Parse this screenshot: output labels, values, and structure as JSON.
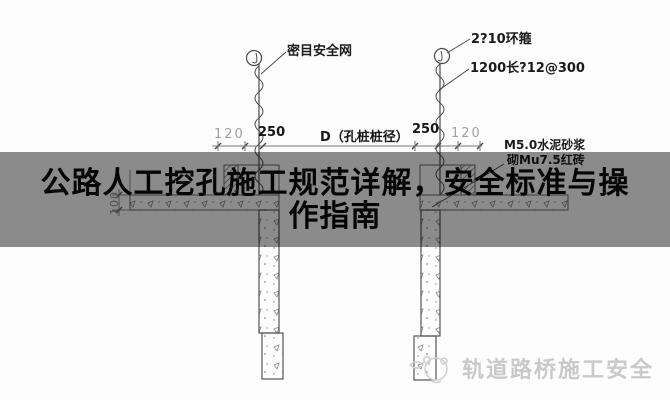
{
  "banner": {
    "title_line1": "公路人工挖孔施工规范详解，安全标准与操",
    "title_line2": "作指南"
  },
  "drawing": {
    "labels": {
      "safety_net": "密目安全网",
      "hoop": "2?10环箍",
      "rebar": "1200长?12@300",
      "mortar": "M5.0水泥砂浆",
      "brick": "砌Mu7.5红砖"
    },
    "dims": {
      "left_outer": "120",
      "left_wall": "250",
      "pile_diameter": "D（孔桩桩径）",
      "right_wall": "250",
      "right_outer": "120",
      "apron_height": "100"
    }
  },
  "watermark": {
    "text": "轨道路桥施工安全"
  },
  "colors": {
    "banner_overlay": "#8c8c8c",
    "line": "#4a4a4a",
    "dim_light": "#a0a0a0",
    "watermark_text": "#c9c9c9",
    "background": "#fdfdfd"
  }
}
